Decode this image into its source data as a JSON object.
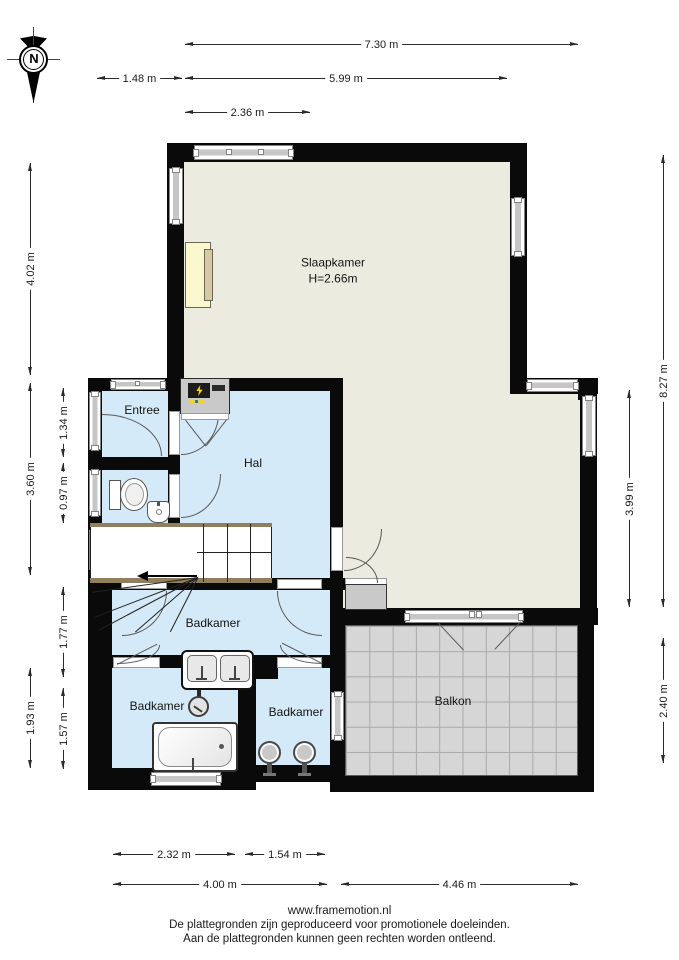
{
  "compass": {
    "north": "N"
  },
  "rooms": {
    "slaapkamer": {
      "name": "Slaapkamer",
      "height": "H=2.66m"
    },
    "entree": {
      "name": "Entree"
    },
    "hal": {
      "name": "Hal"
    },
    "badkamer_main": {
      "name": "Badkamer"
    },
    "badkamer_left": {
      "name": "Badkamer"
    },
    "badkamer_mid": {
      "name": "Badkamer"
    },
    "balkon": {
      "name": "Balkon"
    }
  },
  "dims": {
    "total_width": "7.30 m",
    "left_offset": "1.48 m",
    "upper_width": "5.99 m",
    "window_width": "2.36 m",
    "slaapkamer_height": "4.02 m",
    "mid_height": "3.60 m",
    "lower_height": "1.93 m",
    "entree_height": "1.34 m",
    "toilet_height": "0.97 m",
    "badkamer_height": "1.77 m",
    "bath_height": "1.57 m",
    "total_height": "8.27 m",
    "right_mid_height": "3.99 m",
    "balkon_height": "2.40 m",
    "badkamer_left_width": "2.32 m",
    "badkamer_mid_width": "1.54 m",
    "left_width": "4.00 m",
    "right_width": "4.46 m"
  },
  "footer": {
    "site": "www.framemotion.nl",
    "line1": "De plattegronden zijn geproduceerd voor promotionele doeleinden.",
    "line2": "Aan de plattegronden kunnen geen rechten worden ontleend."
  },
  "colors": {
    "wall": "#0a0a0a",
    "bedroom_floor": "#ecebe0",
    "wet_room_floor": "#d5eaf8",
    "balcony_floor": "#d6d6d6",
    "accent_bed": "#fbf8cf",
    "meter_bolt": "#ffd400"
  }
}
